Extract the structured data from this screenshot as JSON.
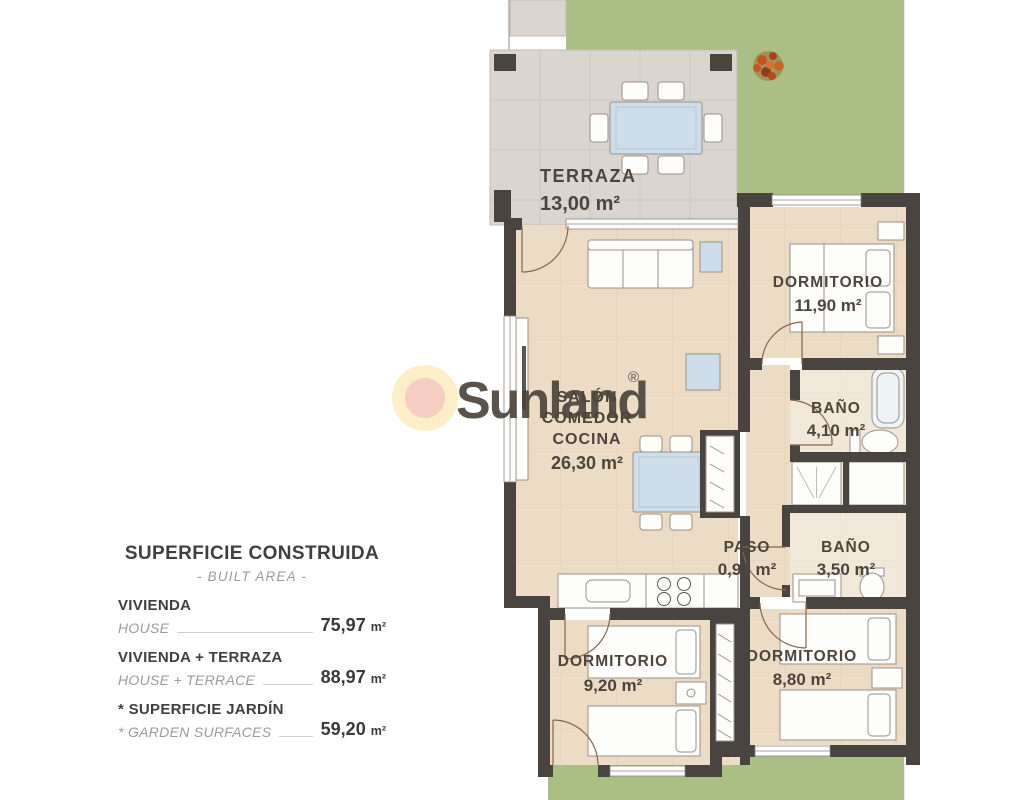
{
  "legend": {
    "title": "SUPERFICIE CONSTRUIDA",
    "subtitle": "- BUILT AREA -",
    "rows": [
      {
        "name_es": "VIVIENDA",
        "name_en": "HOUSE",
        "value": "75,97",
        "unit": "m²"
      },
      {
        "name_es": "VIVIENDA + TERRAZA",
        "name_en": "HOUSE + TERRACE",
        "value": "88,97",
        "unit": "m²"
      },
      {
        "name_es": "* SUPERFICIE JARDÍN",
        "name_en": "* GARDEN SURFACES",
        "value": "59,20",
        "unit": "m²"
      }
    ]
  },
  "rooms": {
    "terraza": {
      "name": "TERRAZA",
      "area": "13,00 m²"
    },
    "salon": {
      "lines": [
        "SALÓN",
        "COMEDOR",
        "COCINA"
      ],
      "area": "26,30 m²"
    },
    "dormitorio1": {
      "name": "DORMITORIO",
      "area": "11,90 m²"
    },
    "bano1": {
      "name": "BAÑO",
      "area": "4,10 m²"
    },
    "paso": {
      "name": "PASO",
      "area": "0,90 m²"
    },
    "bano2": {
      "name": "BAÑO",
      "area": "3,50 m²"
    },
    "dormitorio2": {
      "name": "DORMITORIO",
      "area": "9,20 m²"
    },
    "dormitorio3": {
      "name": "DORMITORIO",
      "area": "8,80 m²"
    }
  },
  "logo": {
    "brand": "Sunland",
    "registered": "®"
  },
  "colors": {
    "garden": "#a9bf83",
    "terrace_tile": "#dad5d0",
    "floor": "#ecdcc6",
    "floor_light": "#f2e8da",
    "wall": "#4a4440",
    "logo_ring": "#fcedc4",
    "logo_core": "#f5c9bc",
    "logo_text": "#b7daf0",
    "label_text": "#4d453c"
  }
}
